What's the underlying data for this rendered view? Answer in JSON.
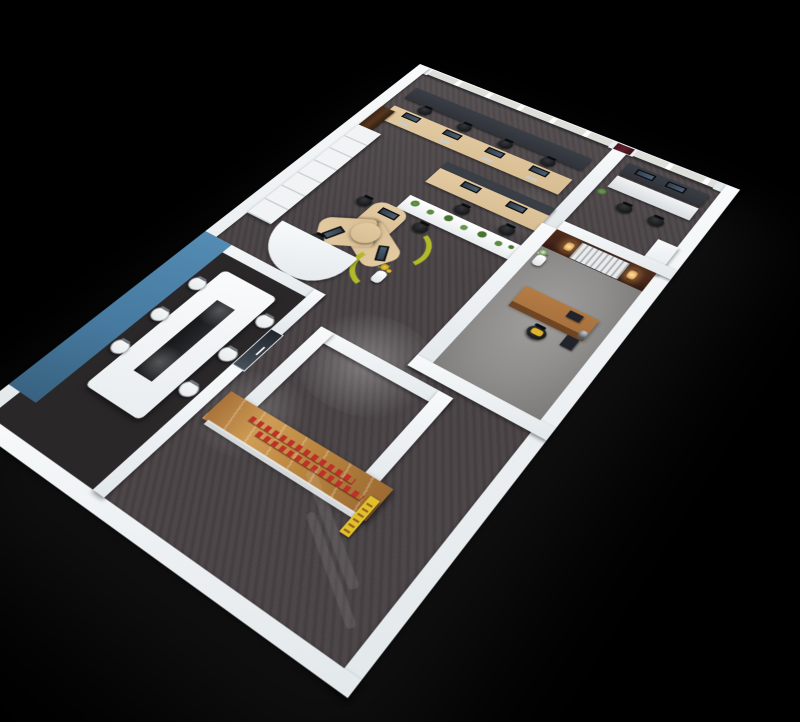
{
  "scene": {
    "description": "3D aerial axonometric render of an office interior floor plan on a black background",
    "canvas": {
      "width": 800,
      "height": 600
    }
  },
  "palette": {
    "background": "#000000",
    "outer_wall": "#eef1f4",
    "carpet_dark": "#4a4446",
    "meeting_floor": "#2a2729",
    "exec_carpet": "#8f8e8c",
    "accent_blue_wall": "#46799f",
    "desk_maple": "#d8bd92",
    "wood_logo_wall": "#b9853f",
    "logo_text_red": "#c03028",
    "sign_yellow": "#dfc12c",
    "divider_green": "#b2ba2a",
    "chair_black": "#17181a",
    "chair_white": "#e9ecee",
    "credenza_dark": "#30333a",
    "plant_green": "#4e7c37",
    "blinds": "#dedfd8",
    "feature_wall_wood": "#45251a",
    "slat_screen": "#d9dadc",
    "door_maroon": "#5f1f2a",
    "door_brown": "#57361f",
    "exec_desk_wood": "#a46e3c"
  },
  "rooms": {
    "open_office": {
      "label": "Open-plan office",
      "window_workstations": 4,
      "second_row_workstations": 2,
      "cluster_workstations": 3,
      "features": [
        "roller-blind windows",
        "dark window credenza",
        "white planter box with plants",
        "curved cluster desk with yellow-green privacy screens",
        "white vase with yellow flowers",
        "wardrobe cabinets along wall",
        "brown wall door"
      ]
    },
    "meeting_room": {
      "label": "Meeting room",
      "chairs": 6,
      "features": [
        "blue accent wall",
        "white conference table",
        "dark center runner",
        "glass entry door",
        "dark carpet"
      ]
    },
    "executive_office": {
      "label": "Executive office",
      "features": [
        "dark wood feature wall",
        "metal slat screen",
        "two warm wall sconces",
        "white flower vase",
        "wood executive desk",
        "black chair with yellow cushion",
        "chrome desk lamp",
        "gray carpet"
      ]
    },
    "small_office": {
      "label": "Private office",
      "features": [
        "roller-blind window",
        "dark credenza with monitors",
        "light desk",
        "two black chairs",
        "potted plant"
      ]
    },
    "reception": {
      "label": "Reception / entrance",
      "features": [
        "timber logo wall with red lettering",
        "yellow wall sign",
        "dark carpet with light reflections"
      ]
    },
    "corridor": {
      "label": "Corridor",
      "features": [
        "dark carpet",
        "ceiling light pools"
      ]
    }
  }
}
